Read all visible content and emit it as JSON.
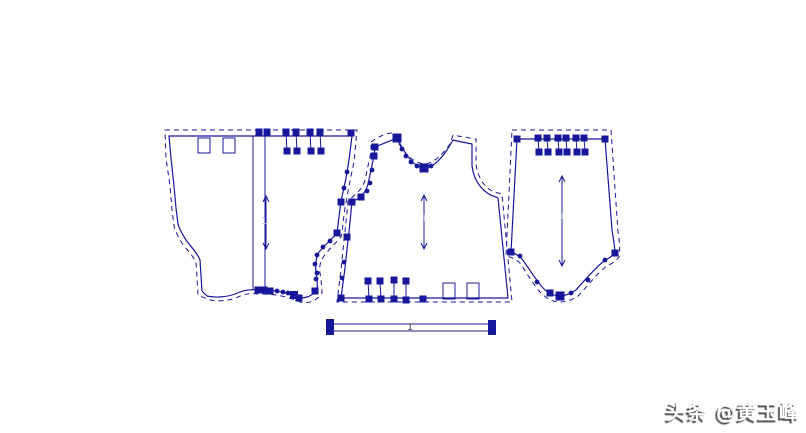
{
  "canvas": {
    "width": 806,
    "height": 433,
    "background": "#ffffff",
    "ink_color": "#17179c",
    "faint_color": "#b9c0e4"
  },
  "watermark": {
    "text": "头条 @黄玉峰"
  },
  "pieces": [
    {
      "name": "pattern-piece-left",
      "solid": [
        "M169,136 L352,136 L349,160 L346,178 L343,192 L341,202 C339,215 338,226 337,233 C331,240 324,246 319,252 C316,258 315,265 316,272 C317,279 318,285 317,290 C311,297 304,299 298,297 C290,294 283,292 276,291 C268,290 262,290 258,290 C250,289 243,290 235,294 C227,297 215,298 207,296 L202,291 L201,276 L200,260 C197,252 190,246 186,240 C181,232 179,228 178,224 L176,208 L174,186 L171,158 Z"
      ],
      "dashed": [
        "M165,130 L357,130 L354,162 L349,186 L346,203 C343,218 343,228 341,237 C335,244 328,250 324,256 C320,262 319,267 320,273 C321,280 322,286 322,293 C316,302 307,304 300,302 C291,298 283,296 276,295 C268,294 262,294 258,294 C249,293 244,294 236,298 C228,301 215,302 207,299 L198,295 L197,278 L196,263 C193,255 186,249 182,243 C177,235 175,230 174,226 L172,210 L170,186 L166,158 Z"
      ],
      "lines": [
        [
          253,
          136,
          253,
          290
        ],
        [
          265,
          136,
          265,
          290
        ],
        [
          286,
          132,
          287,
          151
        ],
        [
          296,
          132,
          297,
          151
        ],
        [
          310,
          132,
          311,
          151
        ],
        [
          320,
          132,
          321,
          151
        ]
      ],
      "rects": [
        [
          198,
          138,
          12,
          15
        ],
        [
          223,
          138,
          12,
          15
        ]
      ],
      "arrow": {
        "x": 266,
        "y1": 196,
        "y2": 249
      },
      "squares": [
        [
          259,
          132
        ],
        [
          267,
          132
        ],
        [
          286,
          132
        ],
        [
          296,
          132
        ],
        [
          287,
          151
        ],
        [
          297,
          151
        ],
        [
          310,
          132
        ],
        [
          320,
          132
        ],
        [
          311,
          151
        ],
        [
          321,
          151
        ],
        [
          351,
          133
        ],
        [
          341,
          202
        ],
        [
          337,
          233
        ],
        [
          258,
          290
        ],
        [
          264,
          290
        ],
        [
          270,
          291
        ],
        [
          294,
          295,
          8
        ],
        [
          299,
          298
        ],
        [
          315,
          291
        ]
      ],
      "dots": [
        [
          347,
          172
        ],
        [
          344,
          188
        ],
        [
          330,
          241
        ],
        [
          323,
          247
        ],
        [
          317,
          255
        ],
        [
          315,
          264
        ],
        [
          317,
          273
        ],
        [
          316,
          279
        ],
        [
          277,
          291
        ],
        [
          283,
          292
        ],
        [
          288,
          293
        ]
      ],
      "faint_label": {
        "text": "1",
        "x": 261,
        "y": 224
      }
    },
    {
      "name": "pattern-piece-middle",
      "solid": [
        "M397,138 C403,150 409,160 416,165 C419,167 422,168 425,168 C433,167 441,159 447,150 L453,140 L457,141 L472,144 L472,166 C474,182 484,194 496,197 L498,198 L508,298 L341,298 L345,268 L348,240 C350,224 351,211 352,202 L361,197 C365,192 367,188 368,184 L371,170 L374,156 L375,147 Z"
      ],
      "dashed": [
        "M371,142 C378,137 386,133 393,133 C399,145 405,154 412,159 C416,162 421,164 425,164 C434,163 443,154 450,144 L453,135 L458,136 L476,139 L476,164 C478,180 487,191 498,193 L502,194 L512,302 L337,302 L341,270 L344,240 C346,224 347,212 348,201 L357,193 C362,188 364,184 365,180 L368,166 L371,152 Z"
      ],
      "lines": [
        [
          368,
          281,
          369,
          299
        ],
        [
          380,
          281,
          381,
          299
        ],
        [
          394,
          280,
          394,
          299
        ],
        [
          406,
          281,
          406,
          300
        ]
      ],
      "rects": [
        [
          443,
          283,
          12,
          16
        ],
        [
          467,
          283,
          12,
          16
        ]
      ],
      "arrow": {
        "x": 424,
        "y1": 195,
        "y2": 249
      },
      "squares": [
        [
          397,
          138,
          9
        ],
        [
          375,
          147
        ],
        [
          374,
          156
        ],
        [
          361,
          197
        ],
        [
          352,
          202
        ],
        [
          347,
          237
        ],
        [
          424,
          168,
          9
        ],
        [
          341,
          298
        ],
        [
          368,
          281
        ],
        [
          380,
          281
        ],
        [
          394,
          280
        ],
        [
          406,
          281
        ],
        [
          369,
          299
        ],
        [
          381,
          299
        ],
        [
          394,
          299
        ],
        [
          406,
          300
        ],
        [
          423,
          299
        ]
      ],
      "dots": [
        [
          402,
          149
        ],
        [
          406,
          156
        ],
        [
          411,
          162
        ],
        [
          417,
          166
        ],
        [
          431,
          166
        ],
        [
          372,
          170
        ],
        [
          370,
          183
        ],
        [
          367,
          191
        ],
        [
          344,
          262
        ],
        [
          342,
          278
        ]
      ],
      "faint_label": {
        "text": "1",
        "x": 421,
        "y": 222
      }
    },
    {
      "name": "pattern-piece-right",
      "solid": [
        "M517,139 L605,139 L612,230 C614,242 615,249 615,253 C611,257 608,259 604,261 C595,268 585,280 576,290 C570,294 565,296 560,296 C553,296 547,292 543,288 C536,280 528,267 522,259 C518,255 514,253 511,252 Z"
      ],
      "dashed": [
        "M512,130 L611,130 L618,232 C620,244 620,252 619,257 C615,262 611,264 607,266 C597,273 588,286 578,296 C572,300 566,302 560,302 C551,302 545,297 540,292 C533,284 526,272 520,263 C516,259 511,257 506,256 Z"
      ],
      "lines": [
        [
          538,
          138,
          539,
          152
        ],
        [
          547,
          138,
          548,
          152
        ],
        [
          558,
          138,
          559,
          152
        ],
        [
          566,
          138,
          567,
          152
        ],
        [
          576,
          138,
          577,
          152
        ],
        [
          584,
          138,
          585,
          152
        ]
      ],
      "rects": [],
      "arrow": {
        "x": 562,
        "y1": 176,
        "y2": 266
      },
      "squares": [
        [
          517,
          139
        ],
        [
          605,
          139
        ],
        [
          538,
          138
        ],
        [
          547,
          138
        ],
        [
          558,
          138
        ],
        [
          566,
          138
        ],
        [
          576,
          138
        ],
        [
          584,
          138
        ],
        [
          539,
          152
        ],
        [
          548,
          152
        ],
        [
          559,
          152
        ],
        [
          567,
          152
        ],
        [
          577,
          152
        ],
        [
          585,
          152
        ],
        [
          511,
          252
        ],
        [
          615,
          253
        ],
        [
          560,
          296,
          9
        ],
        [
          550,
          293
        ]
      ],
      "dots": [
        [
          520,
          256
        ],
        [
          537,
          282
        ],
        [
          571,
          293
        ],
        [
          588,
          280
        ],
        [
          605,
          260
        ]
      ],
      "faint_label": {
        "text": "1",
        "x": 559,
        "y": 220
      }
    }
  ],
  "scale_bar": {
    "label": "1",
    "label_x": 410,
    "label_y": 330,
    "lines": [
      [
        333,
        324,
        490,
        324
      ],
      [
        333,
        331,
        490,
        331
      ]
    ],
    "squares": [
      [
        330,
        323,
        8
      ],
      [
        330,
        331,
        8
      ],
      [
        492,
        324,
        8
      ],
      [
        492,
        331,
        8
      ]
    ]
  }
}
